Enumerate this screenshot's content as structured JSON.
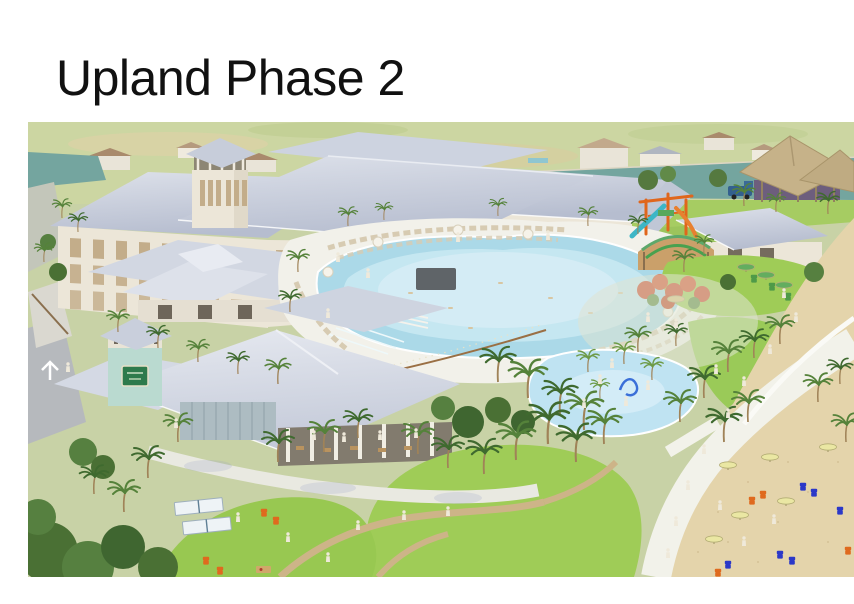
{
  "slide": {
    "title": "Upland Phase 2"
  },
  "rendering": {
    "alt": "Aerial architectural rendering of the Upland Phase 2 resort amenity campus: a large lodge building with cupola tower, lagoon-style pool with lounge chairs, poolside pavilion, playground and splash pad, thatched tiki bar, restaurant pavilion with teal sign tower, event lawn with ping pong and cornhole games, winding promenade, and a sandy beach with umbrellas and Adirondack chairs",
    "features": [
      "main-lodge",
      "cupola-tower",
      "lagoon-pool",
      "pool-deck",
      "poolside-pavilion",
      "playground-structure",
      "shade-canopy",
      "splash-pad",
      "tiki-bar",
      "beach",
      "promenade",
      "restaurant-pavilion",
      "restaurant-sign-tower",
      "event-lawn",
      "ping-pong-tables",
      "cornhole-boards",
      "adirondack-chairs",
      "beach-umbrellas",
      "palm-trees",
      "waterway",
      "neighborhood-background"
    ],
    "colors": {
      "page-bg": "#ffffff",
      "title-color": "#111111",
      "roof-light": "#dde1ea",
      "roof": "#bcc3d3",
      "wall": "#ece6d8",
      "window-tan": "#c3ad8a",
      "pool-water": "#a9d9e8",
      "pool-light": "#d8eef6",
      "deck": "#f2f1ea",
      "canal-water": "#74a59f",
      "splash-water": "#bfe3f2",
      "lawn-green": "#9fcc57",
      "tree-green": "#4a7034",
      "palm-green": "#55823a",
      "palm-green-dark": "#3f6a2f",
      "sand": "#e4d4ab",
      "walkway": "#f2f2ea",
      "path-tan": "#cdb488",
      "thatch": "#c6b289",
      "tower-teal": "#badad0",
      "sign-green": "#2e7a4c",
      "play-orange": "#e0661c",
      "slide-teal": "#3db6c6",
      "chair-orange": "#df6a1e",
      "chair-blue": "#2b38c8",
      "chair-green": "#4f9a48",
      "umbrella-yellow": "#eae7a3",
      "umbrella-green": "#63ad5f",
      "flower-red": "#cc4828",
      "bg-land": "#ccd6a2",
      "figure-white": "#efe9da"
    }
  }
}
